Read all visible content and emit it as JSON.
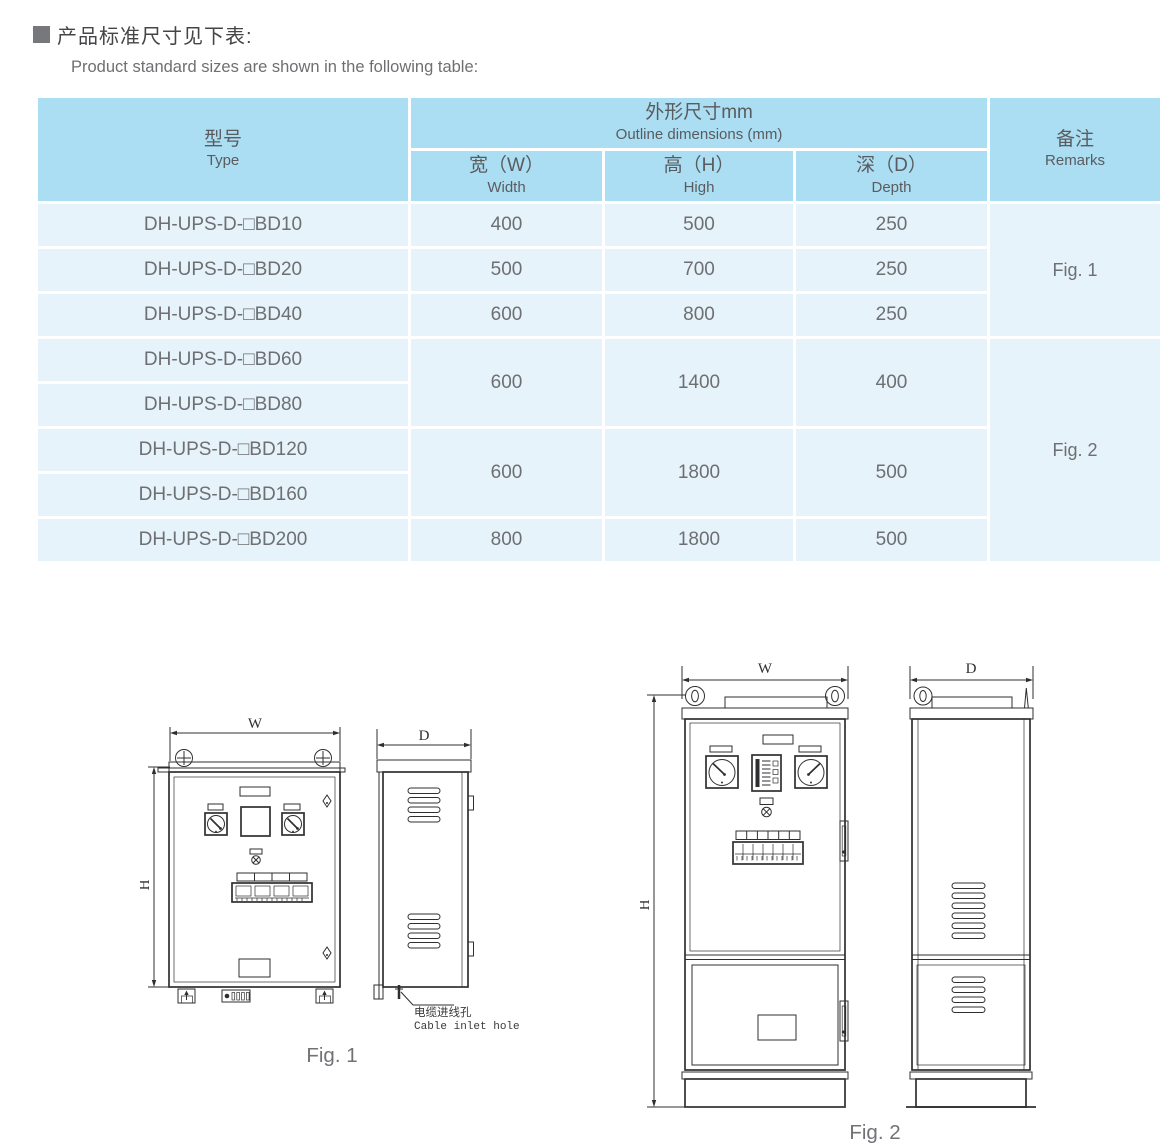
{
  "header": {
    "title_zh": "产品标准尺寸见下表:",
    "subtitle_en": "Product standard sizes are shown in the following table:"
  },
  "table": {
    "header": {
      "type_zh": "型号",
      "type_en": "Type",
      "outline_zh": "外形尺寸mm",
      "outline_en": "Outline dimensions (mm)",
      "width_zh": "宽（W）",
      "width_en": "Width",
      "high_zh": "高（H）",
      "high_en": "High",
      "depth_zh": "深（D）",
      "depth_en": "Depth",
      "remarks_zh": "备注",
      "remarks_en": "Remarks"
    },
    "rows": [
      {
        "type": "DH-UPS-D-□BD10",
        "w": "400",
        "h": "500",
        "d": "250"
      },
      {
        "type": "DH-UPS-D-□BD20",
        "w": "500",
        "h": "700",
        "d": "250"
      },
      {
        "type": "DH-UPS-D-□BD40",
        "w": "600",
        "h": "800",
        "d": "250"
      },
      {
        "type": "DH-UPS-D-□BD60"
      },
      {
        "type": "DH-UPS-D-□BD80"
      },
      {
        "type": "DH-UPS-D-□BD120"
      },
      {
        "type": "DH-UPS-D-□BD160"
      },
      {
        "type": "DH-UPS-D-□BD200",
        "w": "800",
        "h": "1800",
        "d": "500"
      }
    ],
    "merged": {
      "bd60_80": {
        "w": "600",
        "h": "1400",
        "d": "400"
      },
      "bd120_160": {
        "w": "600",
        "h": "1800",
        "d": "500"
      }
    },
    "remarks_fig1": "Fig. 1",
    "remarks_fig2": "Fig. 2"
  },
  "fig1": {
    "caption": "Fig. 1",
    "label_w": "W",
    "label_h": "H",
    "label_d": "D",
    "cable_note_zh": "电缆进线孔",
    "cable_note_en": "Cable inlet hole"
  },
  "fig2": {
    "caption": "Fig. 2",
    "label_w": "W",
    "label_h": "H",
    "label_d": "D"
  },
  "colors": {
    "table_header_blue": "#abdef3",
    "table_row_blue": "#e6f3fb",
    "drawing_line": "#2f2f31",
    "title_text": "#454548",
    "body_text": "#6e6f72"
  }
}
